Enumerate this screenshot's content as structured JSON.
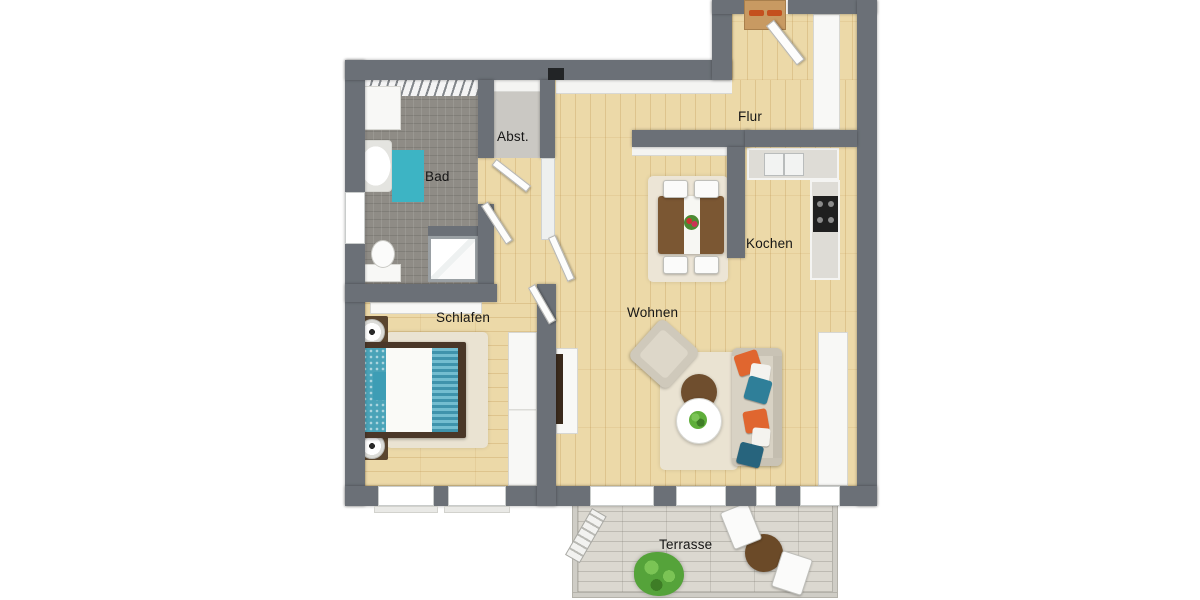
{
  "plan_title": "Apartment floor plan",
  "rooms": {
    "bad": {
      "label": "Bad"
    },
    "abst": {
      "label": "Abst."
    },
    "flur": {
      "label": "Flur"
    },
    "kochen": {
      "label": "Kochen"
    },
    "schlafen": {
      "label": "Schlafen"
    },
    "wohnen": {
      "label": "Wohnen"
    },
    "terrasse": {
      "label": "Terrasse"
    }
  },
  "colors": {
    "wall": "#6b7077",
    "wood_floor": "#ecd9a8",
    "bath_tile": "#8f8c86",
    "storage_floor": "#cac8c3",
    "terrace_deck": "#dbd8d0",
    "accent_teal": "#3db4c4",
    "bed_runner_teal": "#4aa3b8",
    "pillow_teal": "#2f7f99",
    "accent_orange": "#e0662f",
    "sofa_beige": "#d8d2c4",
    "table_brown": "#7b5733",
    "plant_green": "#5fae3a",
    "background": "#ffffff"
  }
}
